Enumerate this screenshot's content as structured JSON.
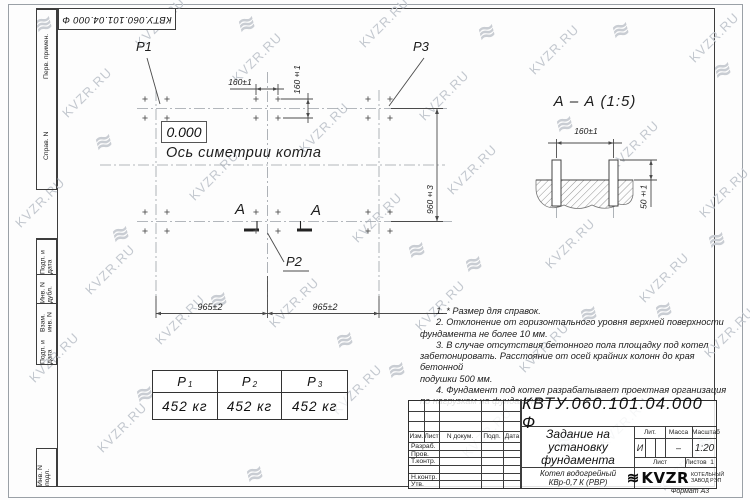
{
  "watermark": {
    "text": "KVZR.RU",
    "glyph": "≋",
    "items": [
      {
        "x": 55,
        "y": 85,
        "r": -45,
        "t": "text"
      },
      {
        "x": 8,
        "y": 195,
        "r": -45,
        "t": "text"
      },
      {
        "x": 78,
        "y": 262,
        "r": -45,
        "t": "text"
      },
      {
        "x": 22,
        "y": 350,
        "r": -45,
        "t": "text"
      },
      {
        "x": 90,
        "y": 420,
        "r": -45,
        "t": "text"
      },
      {
        "x": 182,
        "y": 168,
        "r": -45,
        "t": "text"
      },
      {
        "x": 148,
        "y": 312,
        "r": -45,
        "t": "text"
      },
      {
        "x": 225,
        "y": 50,
        "r": -45,
        "t": "text"
      },
      {
        "x": 292,
        "y": 120,
        "r": -45,
        "t": "text"
      },
      {
        "x": 262,
        "y": 295,
        "r": -45,
        "t": "text"
      },
      {
        "x": 345,
        "y": 210,
        "r": -45,
        "t": "text"
      },
      {
        "x": 325,
        "y": 382,
        "r": -45,
        "t": "text"
      },
      {
        "x": 412,
        "y": 88,
        "r": -45,
        "t": "text"
      },
      {
        "x": 440,
        "y": 162,
        "r": -45,
        "t": "text"
      },
      {
        "x": 408,
        "y": 298,
        "r": -45,
        "t": "text"
      },
      {
        "x": 455,
        "y": 425,
        "r": -45,
        "t": "text"
      },
      {
        "x": 522,
        "y": 42,
        "r": -45,
        "t": "text"
      },
      {
        "x": 538,
        "y": 236,
        "r": -45,
        "t": "text"
      },
      {
        "x": 512,
        "y": 340,
        "r": -45,
        "t": "text"
      },
      {
        "x": 602,
        "y": 138,
        "r": -45,
        "t": "text"
      },
      {
        "x": 632,
        "y": 270,
        "r": -45,
        "t": "text"
      },
      {
        "x": 592,
        "y": 415,
        "r": -45,
        "t": "text"
      },
      {
        "x": 682,
        "y": 30,
        "r": -45,
        "t": "text"
      },
      {
        "x": 692,
        "y": 185,
        "r": -45,
        "t": "text"
      },
      {
        "x": 697,
        "y": 325,
        "r": -45,
        "t": "text"
      },
      {
        "x": 652,
        "y": 458,
        "r": -45,
        "t": "text"
      },
      {
        "x": 352,
        "y": 15,
        "r": -45,
        "t": "text"
      },
      {
        "x": 128,
        "y": 15,
        "r": -45,
        "t": "text"
      },
      {
        "x": 35,
        "y": 12,
        "r": -15,
        "t": "g"
      },
      {
        "x": 238,
        "y": 12,
        "r": -15,
        "t": "g"
      },
      {
        "x": 478,
        "y": 20,
        "r": -15,
        "t": "g"
      },
      {
        "x": 612,
        "y": 18,
        "r": -15,
        "t": "g"
      },
      {
        "x": 714,
        "y": 58,
        "r": -15,
        "t": "g"
      },
      {
        "x": 112,
        "y": 222,
        "r": -15,
        "t": "g"
      },
      {
        "x": 210,
        "y": 288,
        "r": -15,
        "t": "g"
      },
      {
        "x": 336,
        "y": 328,
        "r": -15,
        "t": "g"
      },
      {
        "x": 465,
        "y": 252,
        "r": -15,
        "t": "g"
      },
      {
        "x": 556,
        "y": 112,
        "r": -15,
        "t": "g"
      },
      {
        "x": 580,
        "y": 302,
        "r": -15,
        "t": "g"
      },
      {
        "x": 655,
        "y": 298,
        "r": -15,
        "t": "g"
      },
      {
        "x": 708,
        "y": 228,
        "r": -15,
        "t": "g"
      },
      {
        "x": 136,
        "y": 382,
        "r": -15,
        "t": "g"
      },
      {
        "x": 388,
        "y": 358,
        "r": -15,
        "t": "g"
      },
      {
        "x": 556,
        "y": 428,
        "r": -15,
        "t": "g"
      },
      {
        "x": 696,
        "y": 428,
        "r": -15,
        "t": "g"
      },
      {
        "x": 246,
        "y": 462,
        "r": -15,
        "t": "g"
      },
      {
        "x": 95,
        "y": 130,
        "r": -15,
        "t": "g"
      },
      {
        "x": 408,
        "y": 238,
        "r": -15,
        "t": "g"
      }
    ]
  },
  "top_stamp": "КВТУ.060.101.04.000  Ф",
  "side_strip": {
    "top_labels": [
      "Перв. примен.",
      "Справ. N"
    ],
    "bottom_labels": [
      "Подп. и дата",
      "Инв. N дубл.",
      "Взам. инв. N",
      "Подп. и дата",
      "Инв. N подл."
    ]
  },
  "plan": {
    "p1": "P1",
    "p2": "P2",
    "p3": "P3",
    "level": "0.000",
    "axis_label": "Ось симетрии котла",
    "section_letter": "А",
    "dims": {
      "d160h": "160±1",
      "d160v": "160±1",
      "d960": "960±3",
      "d965l": "965±2",
      "d965r": "965±2"
    }
  },
  "section": {
    "title": "А – А (1:5)",
    "dim160": "160±1",
    "dim50": "50±1"
  },
  "notes": {
    "lines": [
      {
        "text": "1. * Размер для справок.",
        "indent": true
      },
      {
        "text": "2. Отклонение от горизонтального уровня верхней поверхности",
        "indent": true
      },
      {
        "text": "фундамента не более 10 мм.",
        "indent": false
      },
      {
        "text": "3. В случае отсутствия бетонного пола площадку под котел",
        "indent": true
      },
      {
        "text": "забетонировать. Расстояние от осей крайних колонн до края бетонной",
        "indent": false
      },
      {
        "text": "подушки 500 мм.",
        "indent": false
      },
      {
        "text": "4. Фундамент под котел разрабатывает проектная организация",
        "indent": true
      },
      {
        "text": "по нагрузкам на фундамент.",
        "indent": false
      }
    ]
  },
  "load_table": {
    "columns": [
      {
        "sym": "P",
        "sub": "1",
        "value": "452 кг"
      },
      {
        "sym": "P",
        "sub": "2",
        "value": "452 кг"
      },
      {
        "sym": "P",
        "sub": "3",
        "value": "452 кг"
      }
    ]
  },
  "title_block": {
    "doc_number": "КВТУ.060.101.04.000  Ф",
    "title_lines": [
      "Задание на",
      "установку",
      "фундамента"
    ],
    "product_lines": [
      "Котел водогрейный",
      "КВр-0,7 К (РВР)"
    ],
    "rev_headers": [
      "Изм.",
      "Лист",
      "N докум.",
      "Подп.",
      "Дата"
    ],
    "sig_rows": [
      "Разраб.",
      "Пров.",
      "Т.контр.",
      "",
      "Н.контр.",
      "Утв."
    ],
    "lit_header": "Лит.",
    "mass_header": "Масса",
    "scale_header": "Масштаб",
    "lit_value": "И",
    "mass_value": "–",
    "scale_value": "1:20",
    "sheet_label": "Лист",
    "sheets_label": "Листов",
    "sheets_value": "1",
    "logo_text": "KVZR",
    "logo_sub1": "КОТЕЛЬНЫЙ",
    "logo_sub2": "ЗАВОД РЭП",
    "format_label": "Формат А3"
  }
}
